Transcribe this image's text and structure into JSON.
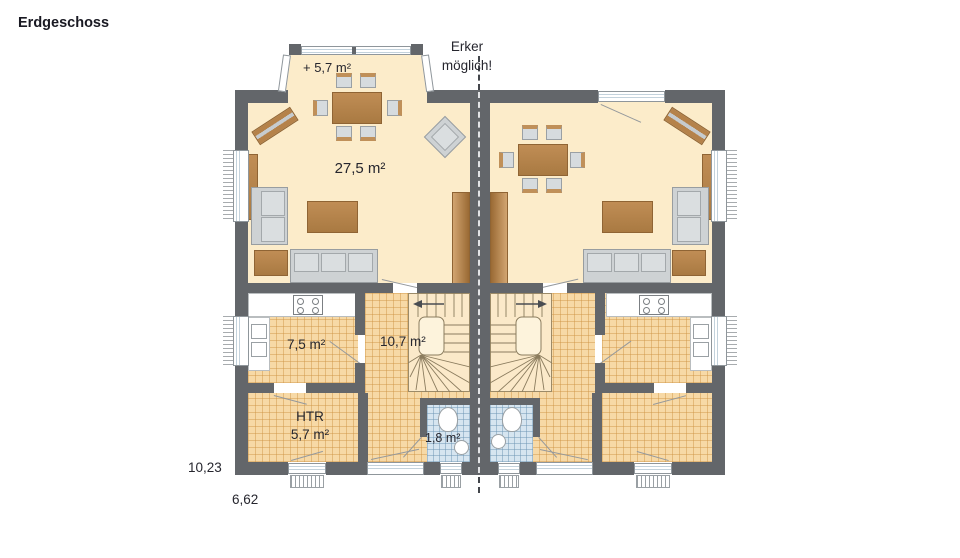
{
  "title": "Erdgeschoss",
  "annotation": {
    "line1": "Erker",
    "line2": "möglich!"
  },
  "labels": {
    "bay": "+ 5,7 m²",
    "living": "27,5 m²",
    "kitchen": "7,5 m²",
    "hall": "10,7 m²",
    "htr_title": "HTR",
    "htr_area": "5,7 m²",
    "wc": "1,8 m²"
  },
  "dimensions": {
    "depth": "10,23",
    "width": "6,62"
  },
  "colors": {
    "wall": "#63666a",
    "living_floor": "#fcecca",
    "tile_floor": "#f7d9a6",
    "wc_floor": "#d6e5f0",
    "wood": "#b5824a"
  }
}
